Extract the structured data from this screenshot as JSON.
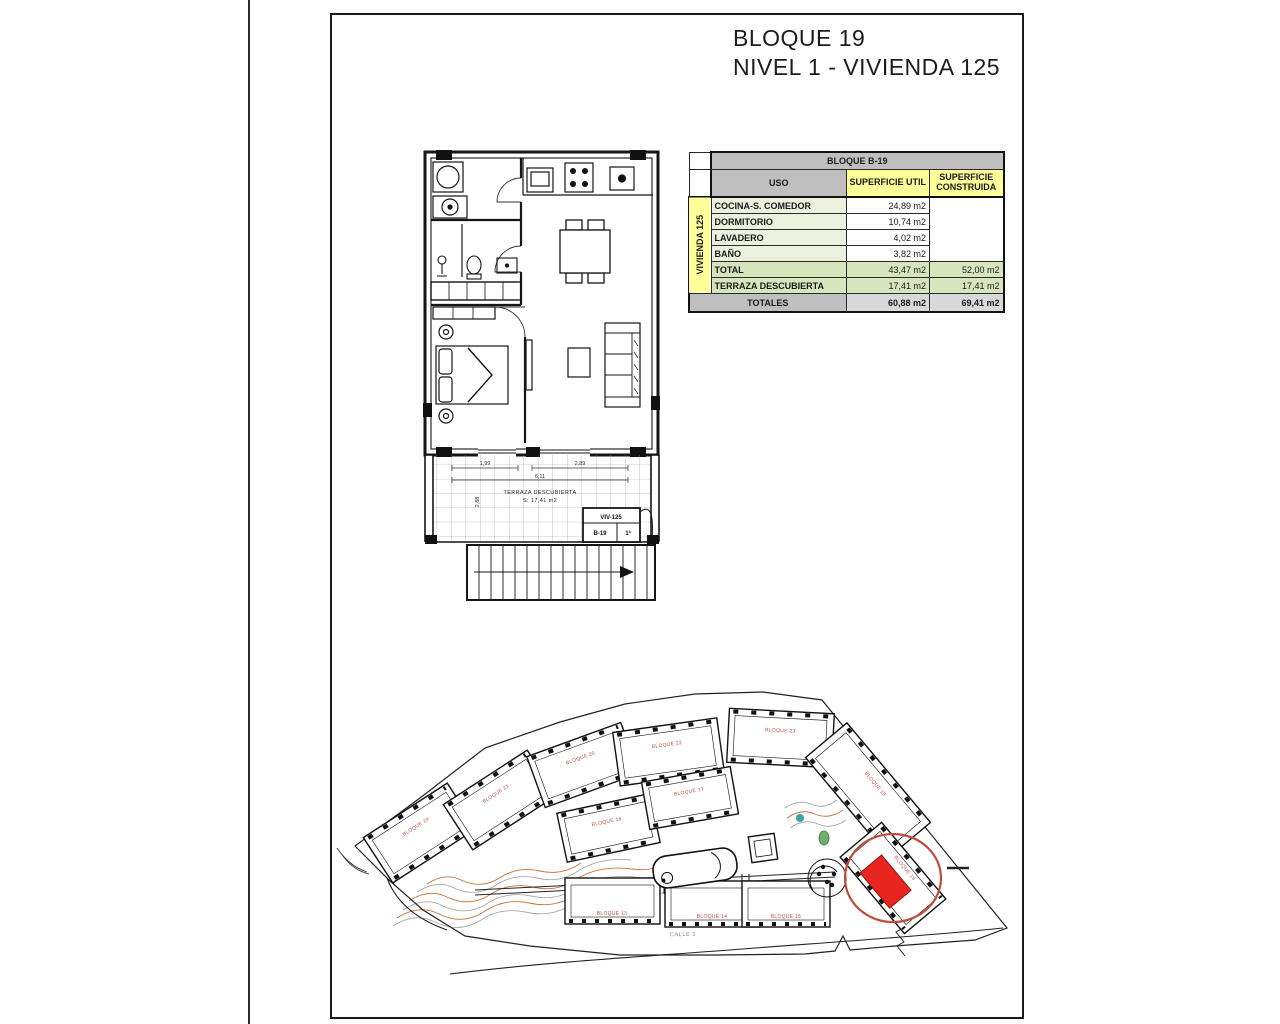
{
  "title": {
    "line1": "BLOQUE 19",
    "line2": "NIVEL 1 - VIVIENDA 125"
  },
  "table": {
    "block_header": "BLOQUE B-19",
    "col_uso": "USO",
    "col_util": "SUPERFICIE UTIL",
    "col_construida": "SUPERFICIE CONSTRUIDA",
    "group_label": "VIVIENDA 125",
    "rooms": [
      {
        "label": "COCINA-S. COMEDOR",
        "util": "24,89 m2"
      },
      {
        "label": "DORMITORIO",
        "util": "10,74 m2"
      },
      {
        "label": "LAVADERO",
        "util": "4,02 m2"
      },
      {
        "label": "BAÑO",
        "util": "3,82 m2"
      }
    ],
    "total": {
      "label": "TOTAL",
      "util": "43,47 m2",
      "construida": "52,00 m2"
    },
    "terraza": {
      "label": "TERRAZA DESCUBIERTA",
      "util": "17,41 m2",
      "construida": "17,41 m2"
    },
    "totales": {
      "label": "TOTALES",
      "util": "60,88 m2",
      "construida": "69,41 m2"
    }
  },
  "floorplan": {
    "terrace_label": "TERRAZA DESCUBIERTA",
    "terrace_area": "S: 17,41 m2",
    "dims": {
      "left": "1,99",
      "right": "2,89",
      "total": "6,11",
      "vert": "2,88"
    },
    "unit_tag": {
      "top": "VIV-125",
      "left": "B-19",
      "right": "1ª"
    }
  },
  "siteplan": {
    "street_label": "CALLE 2",
    "buildings": [
      {
        "label": "BLOQUE 24"
      },
      {
        "label": "BLOQUE 21"
      },
      {
        "label": "BLOQUE 20"
      },
      {
        "label": "BLOQUE 22"
      },
      {
        "label": "BLOQUE 23"
      },
      {
        "label": "BLOQUE 16"
      },
      {
        "label": "BLOQUE 17"
      },
      {
        "label": "BLOQUE 18"
      },
      {
        "label": "BLOQUE 19"
      },
      {
        "label": "BLOQUE 13"
      },
      {
        "label": "BLOQUE 14"
      },
      {
        "label": "BLOQUE 15"
      }
    ]
  },
  "colors": {
    "highlight_red": "#e8251f",
    "circle_red": "#bf4b3a",
    "building_label_red": "#bf4a45",
    "contour_orange": "#c87137",
    "contour_gray": "#a8a8a8",
    "table_gray": "#bfbfbf",
    "table_yellow": "#ffff99",
    "table_green_light": "#ebf1dd",
    "table_green": "#d7e4bc"
  }
}
